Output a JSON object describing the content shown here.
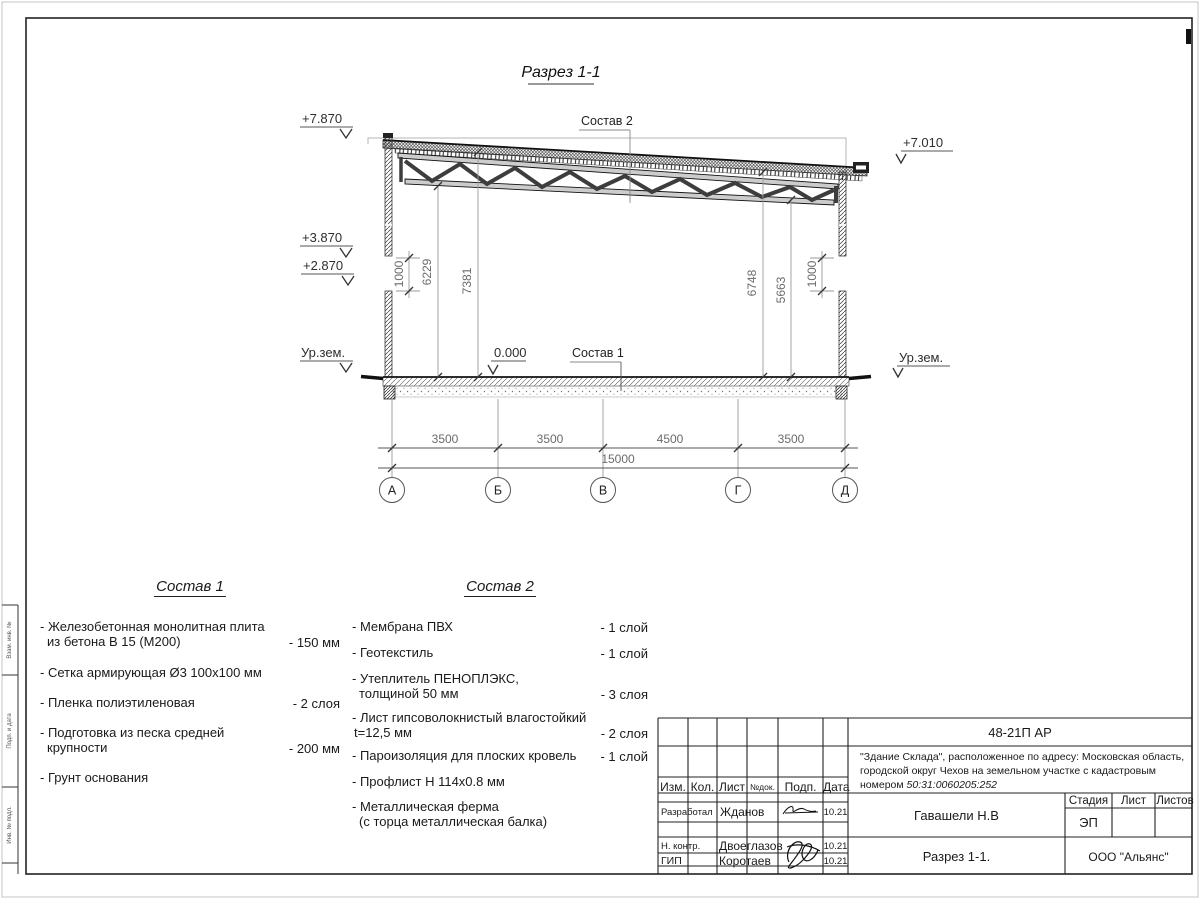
{
  "drawing": {
    "title": "Разрез 1-1",
    "marks": {
      "lvl_7870": "+7.870",
      "lvl_7010": "+7.010",
      "lvl_3870": "+3.870",
      "lvl_2870": "+2.870",
      "ground_left": "Ур.зем.",
      "ground_right": "Ур.зем.",
      "lvl_zero": "0.000",
      "sostav1_ref": "Состав 1",
      "sostav2_ref": "Состав 2"
    },
    "vdims": {
      "left_opening": "1000",
      "h_left_low": "6229",
      "h_left_high": "7381",
      "h_right_high": "6748",
      "h_right_low": "5663",
      "right_opening": "1000"
    },
    "hdims": {
      "spans": [
        "3500",
        "3500",
        "4500",
        "3500"
      ],
      "total": "15000"
    },
    "axes": [
      "А",
      "Б",
      "В",
      "Г",
      "Д"
    ]
  },
  "sostav1": {
    "title": "Состав 1",
    "items": [
      {
        "lines": [
          "- Железобетонная  монолитная плита",
          "из бетона В 15 (М200)"
        ],
        "value": "- 150 мм"
      },
      {
        "lines": [
          "- Сетка армирующая Ø3 100х100 мм",
          ""
        ],
        "value": ""
      },
      {
        "lines": [
          "- Пленка полиэтиленовая",
          ""
        ],
        "value": "-  2 слоя"
      },
      {
        "lines": [
          "- Подготовка из песка средней",
          "крупности"
        ],
        "value": "- 200 мм"
      },
      {
        "lines": [
          "- Грунт основания",
          ""
        ],
        "value": ""
      }
    ]
  },
  "sostav2": {
    "title": "Состав 2",
    "items": [
      {
        "lines": [
          "- Мембрана ПВХ",
          ""
        ],
        "value": "- 1 слой"
      },
      {
        "lines": [
          "- Геотекстиль",
          ""
        ],
        "value": "- 1 слой"
      },
      {
        "lines": [
          "- Утеплитель ПЕНОПЛЭКС,",
          "толщиной 50 мм"
        ],
        "value": "- 3 слоя"
      },
      {
        "lines": [
          "- Лист гипсоволокнистый влагостойкий",
          "t=12,5 мм"
        ],
        "value": "- 2 слоя"
      },
      {
        "lines": [
          "- Пароизоляция для плоских кровель",
          ""
        ],
        "value": "- 1 слой"
      },
      {
        "lines": [
          "- Профлист Н 114х0.8 мм",
          ""
        ],
        "value": ""
      },
      {
        "lines": [
          "- Металлическая ферма",
          "(с торца металлическая балка)"
        ],
        "value": ""
      }
    ]
  },
  "titleblock": {
    "code": "48-21П АР",
    "desc_line1": "\"Здание Склада\", расположенное по адресу: Московская область,",
    "desc_line2": "городской округ Чехов на земельном участке с кадастровым",
    "desc_line3_prefix": "номером ",
    "cadastral": "50:31:0060205:252",
    "cols": [
      "Изм.",
      "Кол.",
      "Лист",
      "№док.",
      "Подп.",
      "Дата"
    ],
    "rows": [
      {
        "role": "Разработал",
        "name": "Жданов",
        "date": "10.21"
      },
      {
        "role": "Н. контр.",
        "name": "Двоеглазов",
        "date": "10.21"
      },
      {
        "role": "ГИП",
        "name": "Коротаев",
        "date": "10.21"
      }
    ],
    "approver": "Гавашели Н.В",
    "stage_label": "Стадия",
    "sheet_label": "Лист",
    "sheets_label": "Листов",
    "stage": "ЭП",
    "doc_name": "Разрез 1-1.",
    "company": "ООО \"Альянс\""
  },
  "frame": {
    "stamp1": "Взам. инв. №",
    "stamp2": "Подп. и дата",
    "stamp3": "Инв. № подл."
  }
}
